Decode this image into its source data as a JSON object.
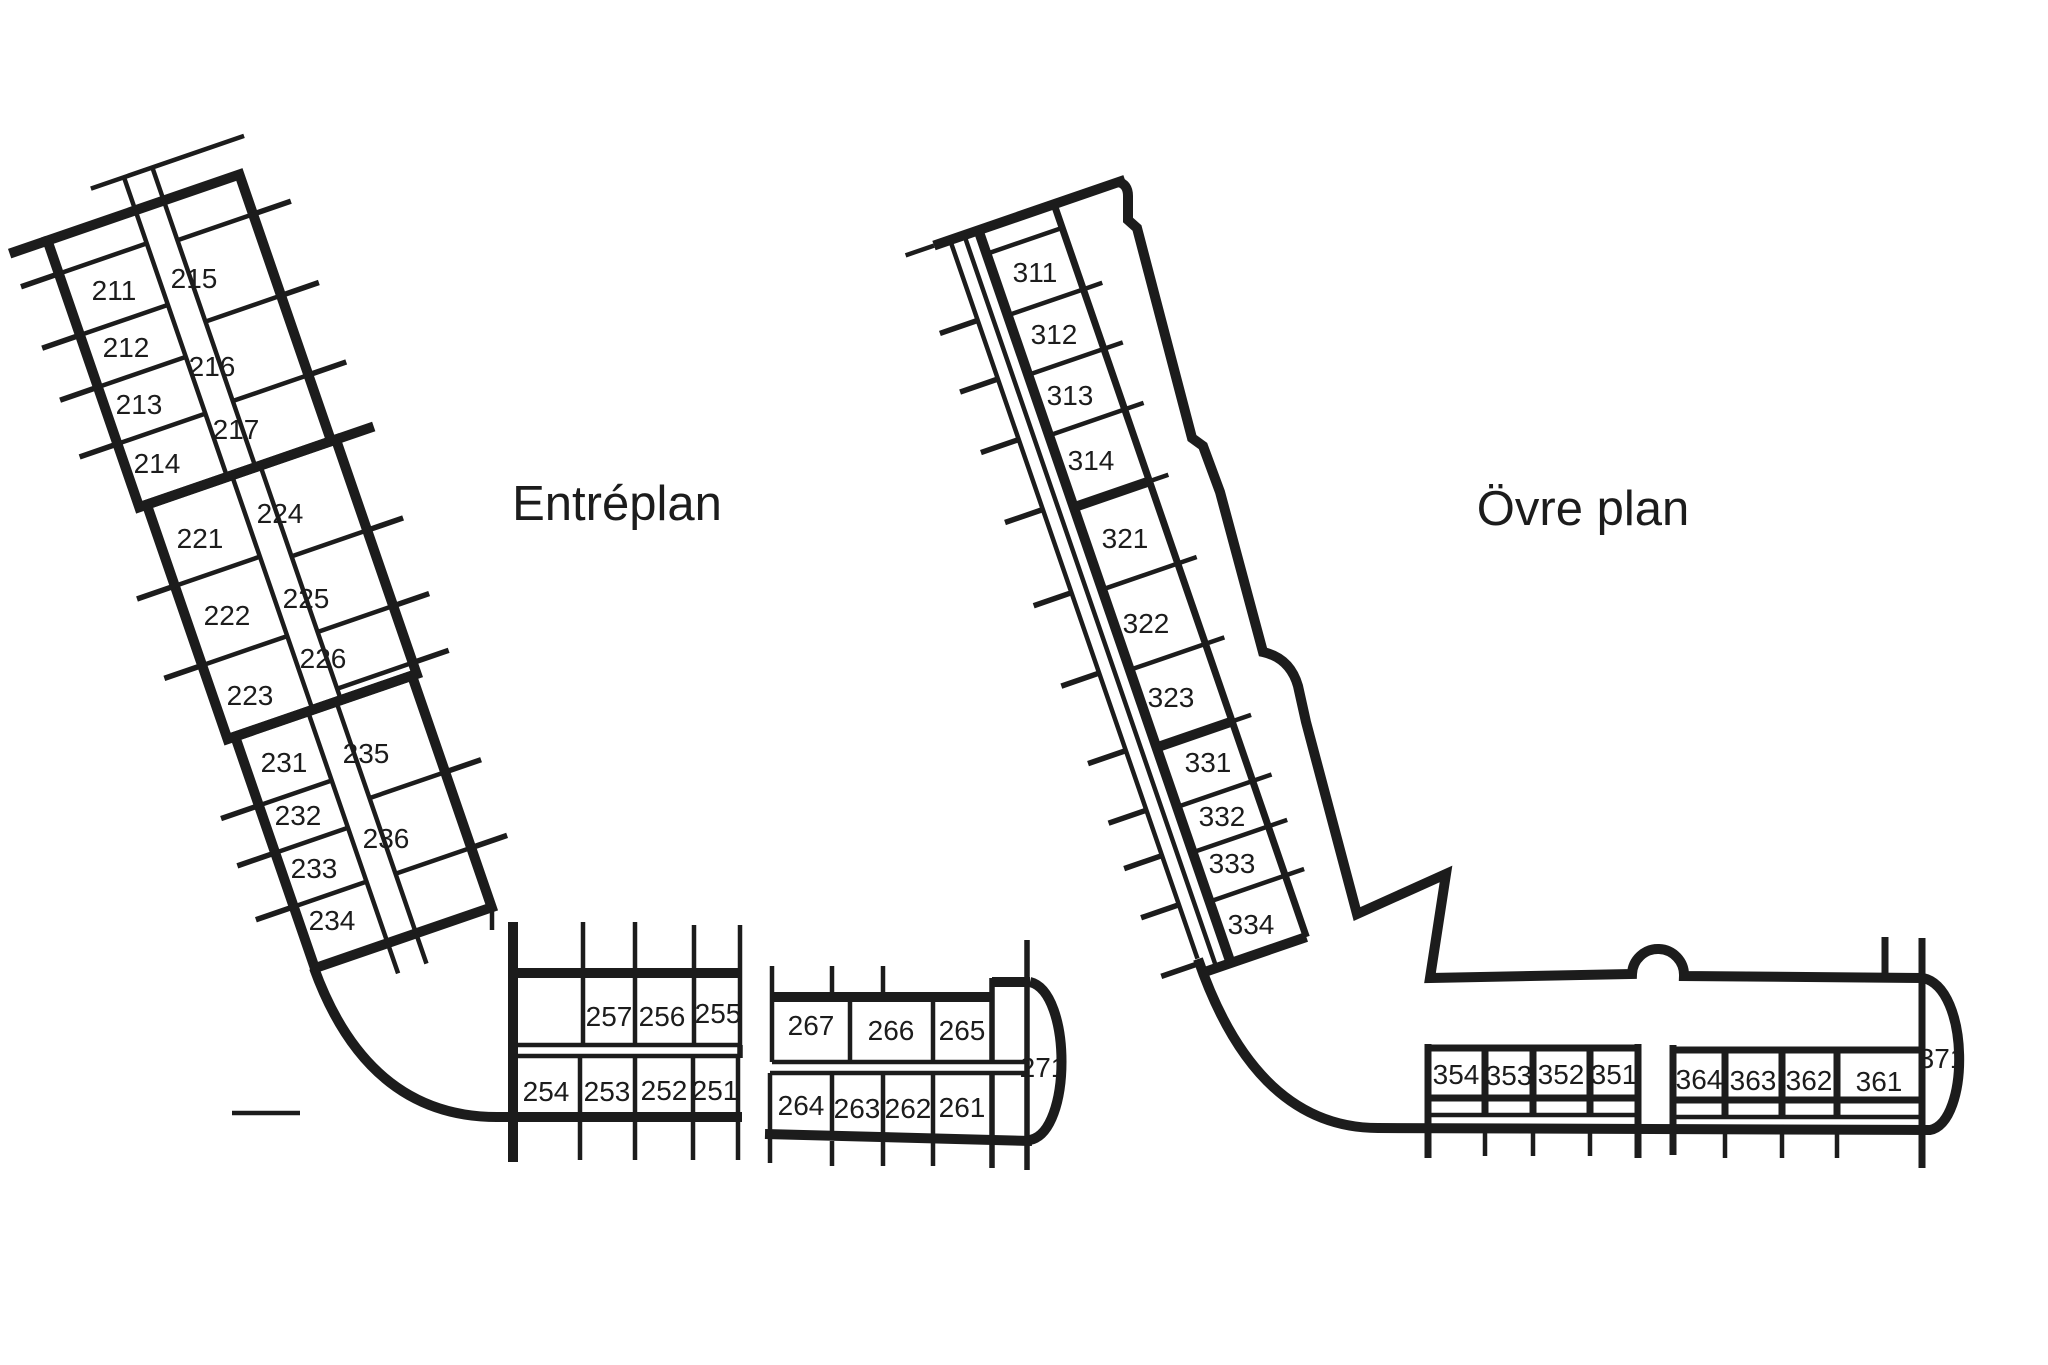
{
  "page": {
    "background": "#ffffff",
    "line_color": "#1c1c1c",
    "description": "Floor plan diagram with two floors and numbered rooms"
  },
  "floors": [
    {
      "name": "entreplan",
      "title": "Entréplan",
      "title_pos": {
        "x": 617,
        "y": 520
      },
      "labels_group": "entreplan-room-labels",
      "rooms": [
        {
          "id": "211",
          "x": 114,
          "y": 300
        },
        {
          "id": "212",
          "x": 126,
          "y": 357
        },
        {
          "id": "213",
          "x": 139,
          "y": 414
        },
        {
          "id": "214",
          "x": 157,
          "y": 473
        },
        {
          "id": "215",
          "x": 194,
          "y": 288
        },
        {
          "id": "216",
          "x": 212,
          "y": 376
        },
        {
          "id": "217",
          "x": 236,
          "y": 439
        },
        {
          "id": "221",
          "x": 200,
          "y": 548
        },
        {
          "id": "222",
          "x": 227,
          "y": 625
        },
        {
          "id": "223",
          "x": 250,
          "y": 705
        },
        {
          "id": "224",
          "x": 280,
          "y": 523
        },
        {
          "id": "225",
          "x": 306,
          "y": 608
        },
        {
          "id": "226",
          "x": 323,
          "y": 668
        },
        {
          "id": "231",
          "x": 284,
          "y": 772
        },
        {
          "id": "232",
          "x": 298,
          "y": 825
        },
        {
          "id": "233",
          "x": 314,
          "y": 878
        },
        {
          "id": "234",
          "x": 332,
          "y": 930
        },
        {
          "id": "235",
          "x": 366,
          "y": 763
        },
        {
          "id": "236",
          "x": 386,
          "y": 848
        },
        {
          "id": "257",
          "x": 609,
          "y": 1026
        },
        {
          "id": "256",
          "x": 662,
          "y": 1026
        },
        {
          "id": "255",
          "x": 718,
          "y": 1023
        },
        {
          "id": "267",
          "x": 811,
          "y": 1035
        },
        {
          "id": "266",
          "x": 891,
          "y": 1040
        },
        {
          "id": "265",
          "x": 962,
          "y": 1040
        },
        {
          "id": "254",
          "x": 546,
          "y": 1101
        },
        {
          "id": "253",
          "x": 607,
          "y": 1101
        },
        {
          "id": "252",
          "x": 664,
          "y": 1100
        },
        {
          "id": "251",
          "x": 715,
          "y": 1100
        },
        {
          "id": "264",
          "x": 801,
          "y": 1115
        },
        {
          "id": "263",
          "x": 857,
          "y": 1118
        },
        {
          "id": "262",
          "x": 908,
          "y": 1118
        },
        {
          "id": "261",
          "x": 962,
          "y": 1117
        },
        {
          "id": "271",
          "x": 1043,
          "y": 1077
        }
      ]
    },
    {
      "name": "ovre-plan",
      "title": "Övre plan",
      "title_pos": {
        "x": 1583,
        "y": 525
      },
      "labels_group": "ovreplan-room-labels",
      "rooms": [
        {
          "id": "311",
          "x": 1035,
          "y": 282
        },
        {
          "id": "312",
          "x": 1054,
          "y": 344
        },
        {
          "id": "313",
          "x": 1070,
          "y": 405
        },
        {
          "id": "314",
          "x": 1091,
          "y": 470
        },
        {
          "id": "321",
          "x": 1125,
          "y": 548
        },
        {
          "id": "322",
          "x": 1146,
          "y": 633
        },
        {
          "id": "323",
          "x": 1171,
          "y": 707
        },
        {
          "id": "331",
          "x": 1208,
          "y": 772
        },
        {
          "id": "332",
          "x": 1222,
          "y": 826
        },
        {
          "id": "333",
          "x": 1232,
          "y": 873
        },
        {
          "id": "334",
          "x": 1251,
          "y": 934
        },
        {
          "id": "354",
          "x": 1456,
          "y": 1084
        },
        {
          "id": "353",
          "x": 1509,
          "y": 1085
        },
        {
          "id": "352",
          "x": 1561,
          "y": 1084
        },
        {
          "id": "351",
          "x": 1614,
          "y": 1084
        },
        {
          "id": "364",
          "x": 1699,
          "y": 1089
        },
        {
          "id": "363",
          "x": 1753,
          "y": 1090
        },
        {
          "id": "362",
          "x": 1809,
          "y": 1090
        },
        {
          "id": "361",
          "x": 1879,
          "y": 1091
        },
        {
          "id": "371",
          "x": 1942,
          "y": 1068
        }
      ]
    }
  ]
}
